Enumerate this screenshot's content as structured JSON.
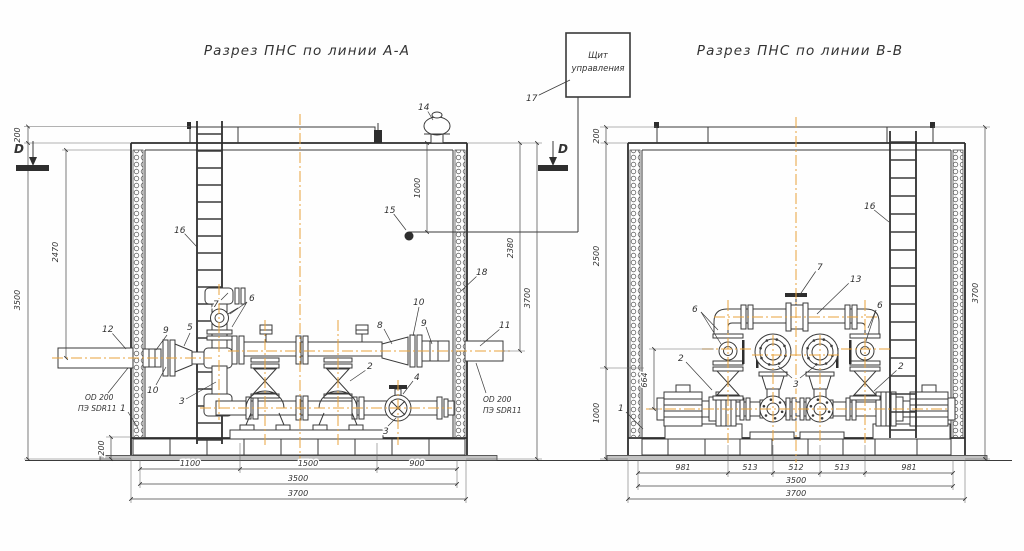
{
  "titles": {
    "left": "Разрез ПНС по линии А-А",
    "right": "Разрез ПНС по линии В-В"
  },
  "control_panel": {
    "line1": "Щит",
    "line2": "управления",
    "item": "17"
  },
  "section_markers": {
    "left": "D",
    "right": "D"
  },
  "pipe_spec": {
    "line1": "OD 200",
    "line2": "ПЭ SDR11"
  },
  "colors": {
    "line": "#3a3a3a",
    "centerline": "#e8a33c",
    "base_plate": "#c2c2c2"
  },
  "left_view": {
    "dims": {
      "roof_height": "200",
      "wall_height": "3500",
      "inlet_drop": "2470",
      "base_height": "200",
      "bay1": "1100",
      "bay2": "1500",
      "bay3": "900",
      "width_inner": "3500",
      "width_outer": "3700",
      "sensor_drop": "1000",
      "outlet_drop": "2380",
      "total_height": "3700"
    },
    "items": {
      "i1": "1",
      "i2": "2",
      "i3a": "3",
      "i3b": "3",
      "i4": "4",
      "i5": "5",
      "i6": "6",
      "i7": "7",
      "i8": "8",
      "i9a": "9",
      "i9b": "9",
      "i10a": "10",
      "i10b": "10",
      "i11": "11",
      "i12": "12",
      "i14": "14",
      "i15": "15",
      "i16": "16",
      "i18": "18"
    }
  },
  "right_view": {
    "dims": {
      "roof_height": "200",
      "upper_height": "2500",
      "lower_height": "1000",
      "valve_axis": "664",
      "bay1": "981",
      "bay2": "513",
      "bay3": "512",
      "bay4": "513",
      "bay5": "981",
      "width_inner": "3500",
      "width_outer": "3700",
      "total_height": "3700"
    },
    "items": {
      "i1": "1",
      "i2a": "2",
      "i2b": "2",
      "i3": "3",
      "i6a": "6",
      "i6b": "6",
      "i7": "7",
      "i13": "13",
      "i16": "16"
    }
  }
}
